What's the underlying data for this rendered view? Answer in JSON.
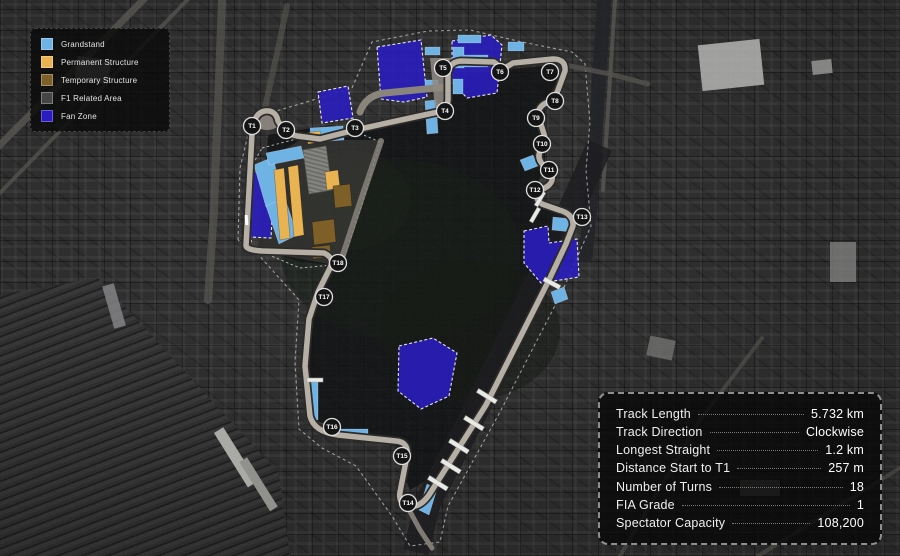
{
  "legend": {
    "items": [
      {
        "label": "Grandstand",
        "type": "grandstand",
        "color": "#6fb2e4"
      },
      {
        "label": "Permanent Structure",
        "type": "permanent",
        "color": "#eab352"
      },
      {
        "label": "Temporary Structure",
        "type": "temporary",
        "color": "#7d5f27"
      },
      {
        "label": "F1 Related Area",
        "type": "f1",
        "color": "#454545"
      },
      {
        "label": "Fan Zone",
        "type": "fan",
        "color": "#2a1cc0"
      }
    ]
  },
  "stats": {
    "rows": [
      {
        "label": "Track Length",
        "value": "5.732 km"
      },
      {
        "label": "Track Direction",
        "value": "Clockwise"
      },
      {
        "label": "Longest Straight",
        "value": "1.2 km"
      },
      {
        "label": "Distance Start to T1",
        "value": "257 m"
      },
      {
        "label": "Number of Turns",
        "value": "18"
      },
      {
        "label": "FIA Grade",
        "value": "1"
      },
      {
        "label": "Spectator Capacity",
        "value": "108,200"
      }
    ]
  },
  "map": {
    "turns": [
      {
        "label": "T1",
        "x": 252,
        "y": 126
      },
      {
        "label": "T2",
        "x": 286,
        "y": 130
      },
      {
        "label": "T3",
        "x": 355,
        "y": 128
      },
      {
        "label": "T4",
        "x": 445,
        "y": 111
      },
      {
        "label": "T5",
        "x": 443,
        "y": 68
      },
      {
        "label": "T6",
        "x": 500,
        "y": 72
      },
      {
        "label": "T7",
        "x": 550,
        "y": 72
      },
      {
        "label": "T8",
        "x": 555,
        "y": 101
      },
      {
        "label": "T9",
        "x": 536,
        "y": 118
      },
      {
        "label": "T10",
        "x": 542,
        "y": 144
      },
      {
        "label": "T11",
        "x": 549,
        "y": 170
      },
      {
        "label": "T12",
        "x": 535,
        "y": 190
      },
      {
        "label": "T13",
        "x": 582,
        "y": 217
      },
      {
        "label": "T14",
        "x": 408,
        "y": 503
      },
      {
        "label": "T15",
        "x": 402,
        "y": 456
      },
      {
        "label": "T16",
        "x": 332,
        "y": 427
      },
      {
        "label": "T17",
        "x": 324,
        "y": 297
      },
      {
        "label": "T18",
        "x": 338,
        "y": 263
      }
    ]
  },
  "colors": {
    "grandstand": "#6fb2e4",
    "permanent": "#eab352",
    "temporary": "#7d5f27",
    "f1_related": "#454545",
    "fan_zone": "#2a1cc0",
    "track": "#b5afa6"
  }
}
